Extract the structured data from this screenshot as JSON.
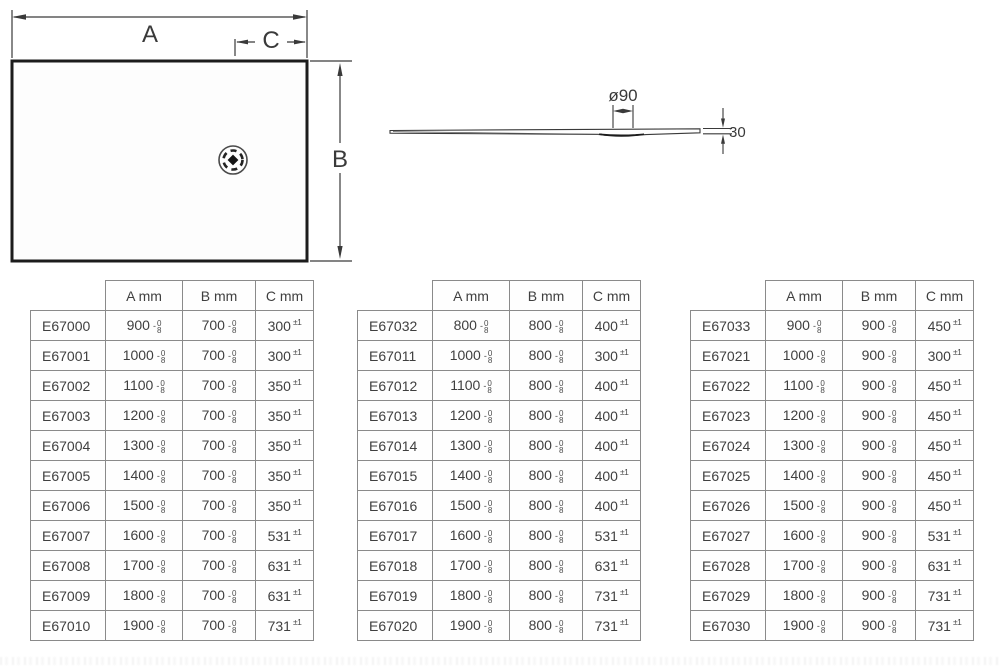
{
  "plan_view": {
    "width_label": "A",
    "height_label": "B",
    "drain_offset_label": "C"
  },
  "profile_view": {
    "drain_diameter_label": "ø90",
    "thickness_label": "30"
  },
  "table_headers": [
    "A mm",
    "B mm",
    "C mm"
  ],
  "tolerances": {
    "ab_sign": "-",
    "ab_upper": "0",
    "ab_lower": "8",
    "c": "±1"
  },
  "tables": [
    {
      "rows": [
        [
          "E67000",
          "900",
          "700",
          "300"
        ],
        [
          "E67001",
          "1000",
          "700",
          "300"
        ],
        [
          "E67002",
          "1100",
          "700",
          "350"
        ],
        [
          "E67003",
          "1200",
          "700",
          "350"
        ],
        [
          "E67004",
          "1300",
          "700",
          "350"
        ],
        [
          "E67005",
          "1400",
          "700",
          "350"
        ],
        [
          "E67006",
          "1500",
          "700",
          "350"
        ],
        [
          "E67007",
          "1600",
          "700",
          "531"
        ],
        [
          "E67008",
          "1700",
          "700",
          "631"
        ],
        [
          "E67009",
          "1800",
          "700",
          "631"
        ],
        [
          "E67010",
          "1900",
          "700",
          "731"
        ]
      ]
    },
    {
      "rows": [
        [
          "E67032",
          "800",
          "800",
          "400"
        ],
        [
          "E67011",
          "1000",
          "800",
          "300"
        ],
        [
          "E67012",
          "1100",
          "800",
          "400"
        ],
        [
          "E67013",
          "1200",
          "800",
          "400"
        ],
        [
          "E67014",
          "1300",
          "800",
          "400"
        ],
        [
          "E67015",
          "1400",
          "800",
          "400"
        ],
        [
          "E67016",
          "1500",
          "800",
          "400"
        ],
        [
          "E67017",
          "1600",
          "800",
          "531"
        ],
        [
          "E67018",
          "1700",
          "800",
          "631"
        ],
        [
          "E67019",
          "1800",
          "800",
          "731"
        ],
        [
          "E67020",
          "1900",
          "800",
          "731"
        ]
      ]
    },
    {
      "rows": [
        [
          "E67033",
          "900",
          "900",
          "450"
        ],
        [
          "E67021",
          "1000",
          "900",
          "300"
        ],
        [
          "E67022",
          "1100",
          "900",
          "450"
        ],
        [
          "E67023",
          "1200",
          "900",
          "450"
        ],
        [
          "E67024",
          "1300",
          "900",
          "450"
        ],
        [
          "E67025",
          "1400",
          "900",
          "450"
        ],
        [
          "E67026",
          "1500",
          "900",
          "450"
        ],
        [
          "E67027",
          "1600",
          "900",
          "531"
        ],
        [
          "E67028",
          "1700",
          "900",
          "631"
        ],
        [
          "E67029",
          "1800",
          "900",
          "731"
        ],
        [
          "E67030",
          "1900",
          "900",
          "731"
        ]
      ]
    }
  ]
}
